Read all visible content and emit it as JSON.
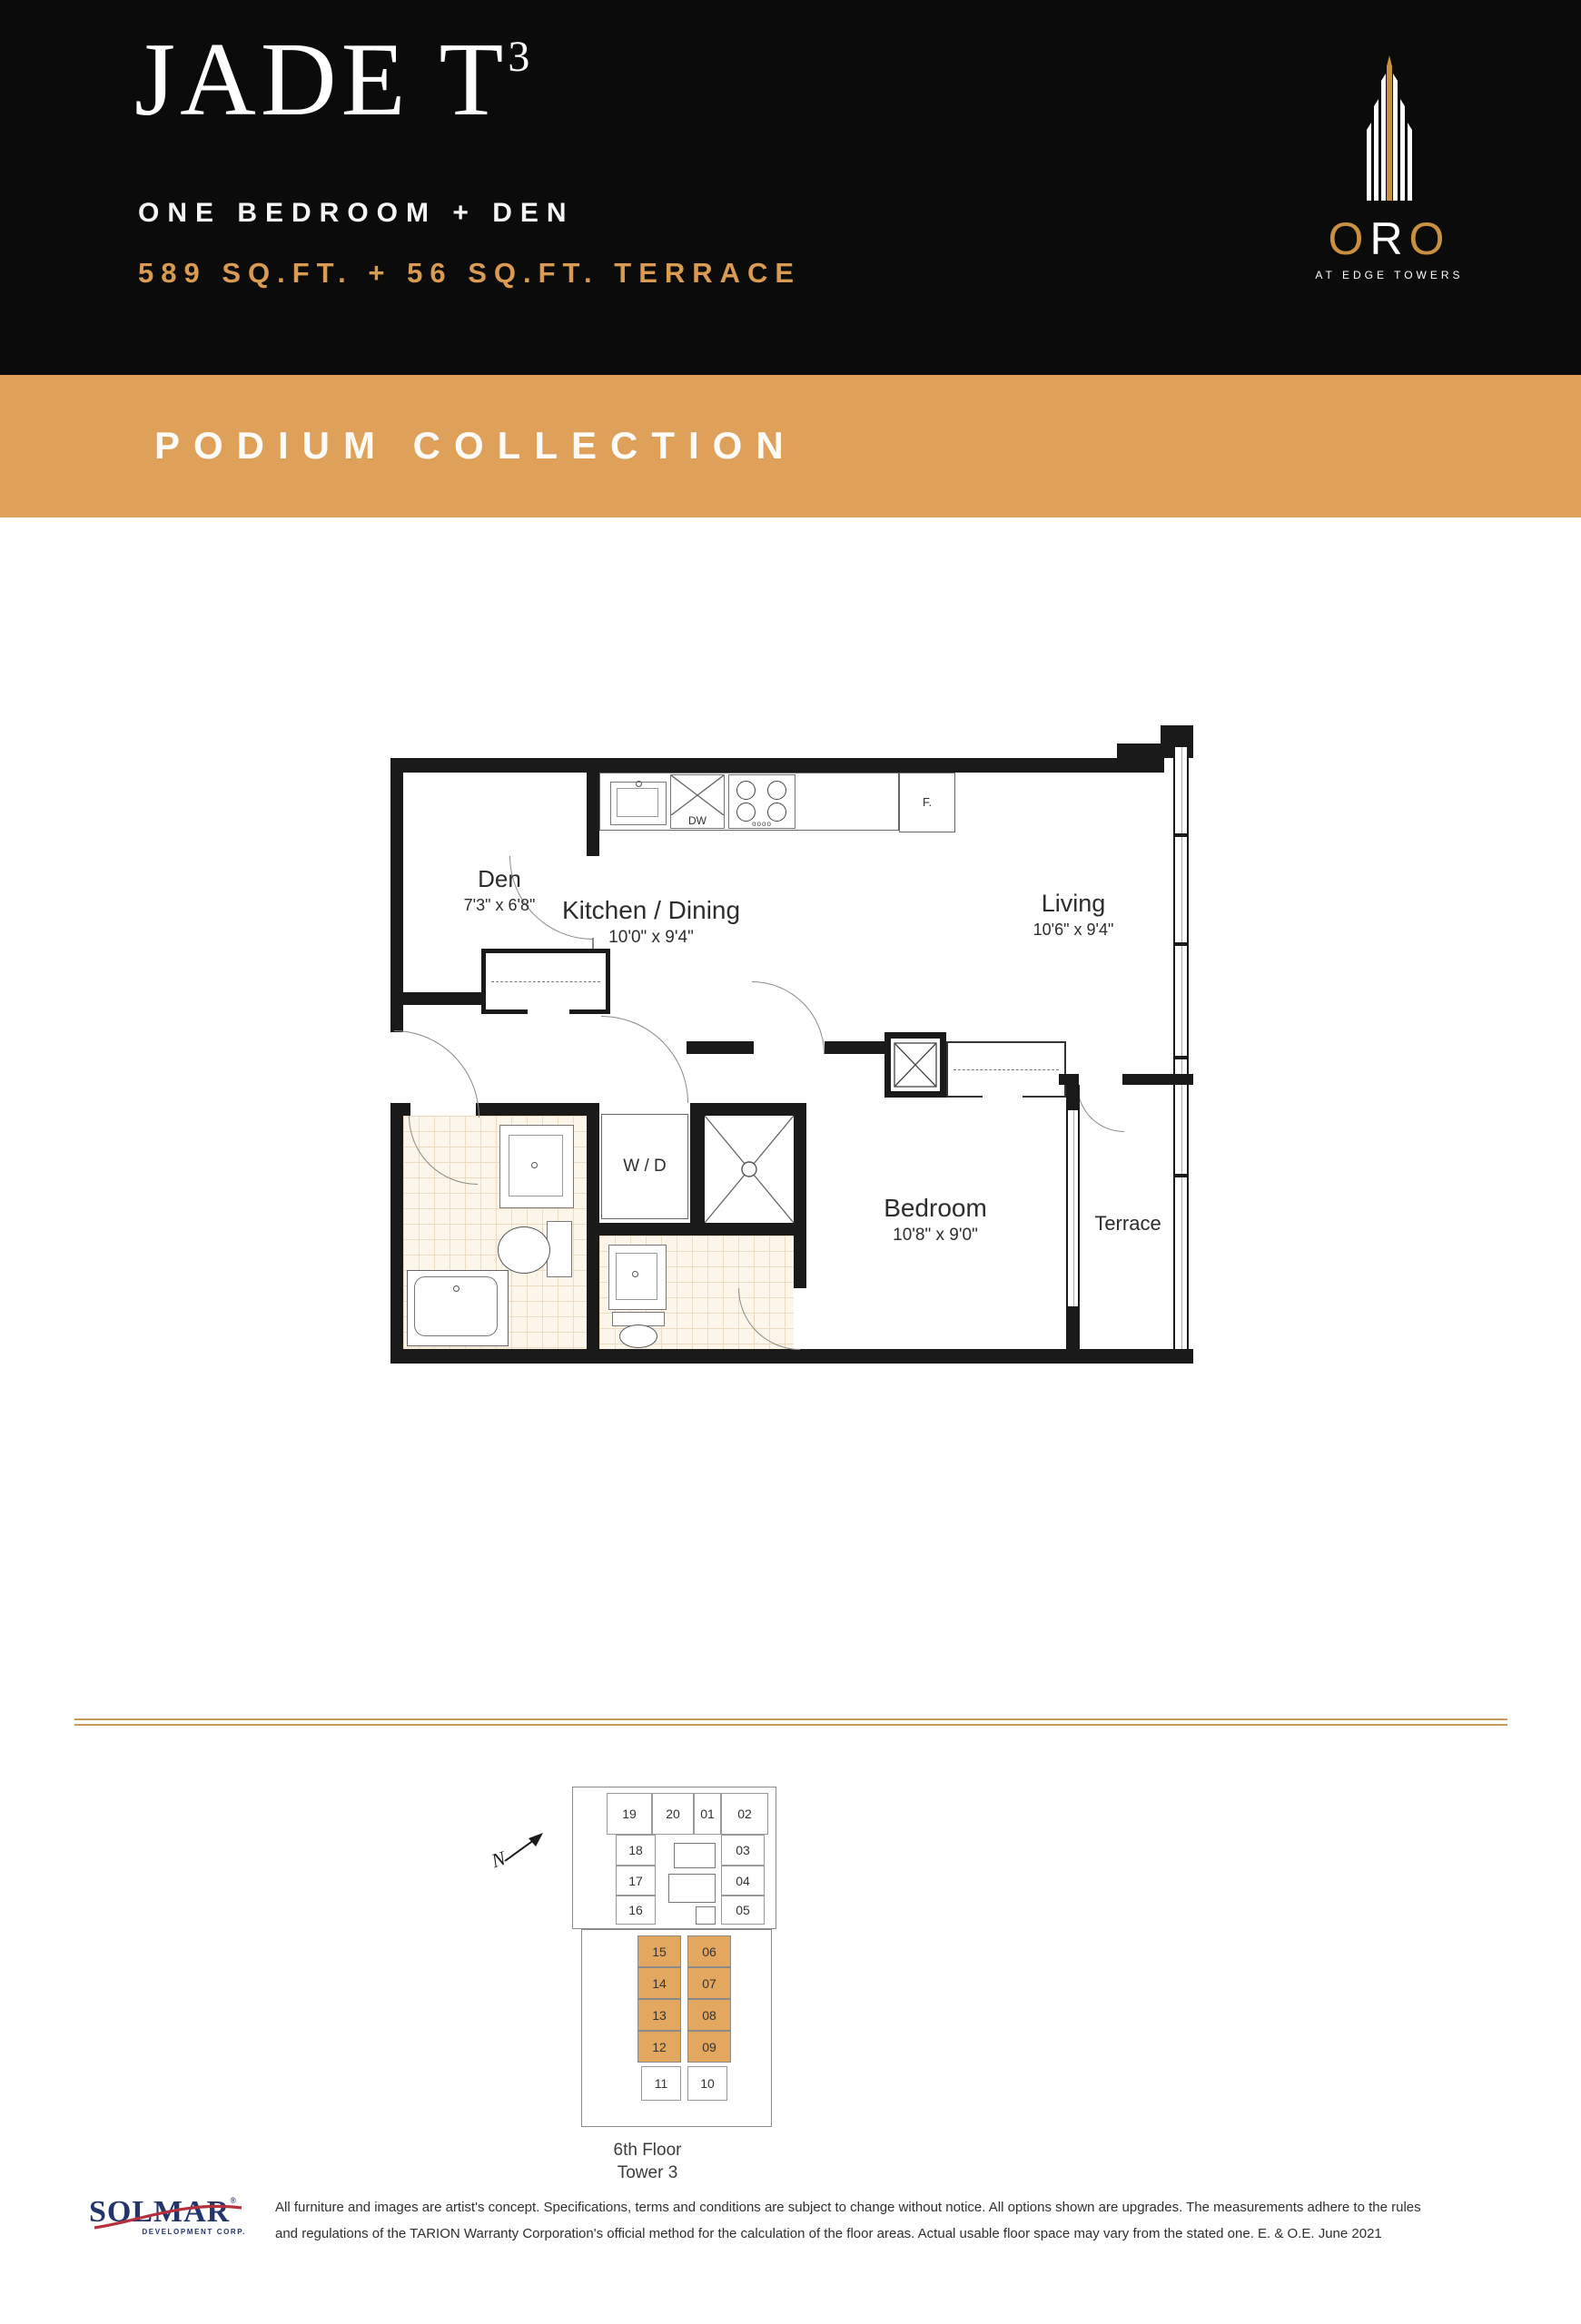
{
  "header": {
    "title": "JADE T",
    "title_sup": "3",
    "subtitle": "ONE BEDROOM + DEN",
    "area_line": "589 SQ.FT. + 56 SQ.FT. TERRACE",
    "logo": {
      "name_o1": "O",
      "name_r": "R",
      "name_o2": "O",
      "tagline": "AT EDGE TOWERS"
    }
  },
  "banner": {
    "label": "PODIUM COLLECTION"
  },
  "floorplan": {
    "rooms": [
      {
        "name": "Den",
        "dims": "7'3\" x 6'8\""
      },
      {
        "name": "Kitchen / Dining",
        "dims": "10'0\" x 9'4\""
      },
      {
        "name": "Living",
        "dims": "10'6\" x 9'4\""
      },
      {
        "name": "Bedroom",
        "dims": "10'8\" x 9'0\""
      },
      {
        "name": "Terrace",
        "dims": ""
      }
    ],
    "labels": {
      "washer_dryer": "W / D",
      "dishwasher": "DW",
      "fridge": "F."
    }
  },
  "keyplan": {
    "north_label": "N",
    "caption_line1": "6th Floor",
    "caption_line2": "Tower 3",
    "units": [
      {
        "label": "19",
        "slot": "u19",
        "highlighted": false
      },
      {
        "label": "20",
        "slot": "u20",
        "highlighted": false
      },
      {
        "label": "01",
        "slot": "u01",
        "highlighted": false
      },
      {
        "label": "02",
        "slot": "u02",
        "highlighted": false
      },
      {
        "label": "18",
        "slot": "u18",
        "highlighted": false
      },
      {
        "label": "17",
        "slot": "u17",
        "highlighted": false
      },
      {
        "label": "16",
        "slot": "u16",
        "highlighted": false
      },
      {
        "label": "03",
        "slot": "u03",
        "highlighted": false
      },
      {
        "label": "04",
        "slot": "u04",
        "highlighted": false
      },
      {
        "label": "05",
        "slot": "u05",
        "highlighted": false
      },
      {
        "label": "15",
        "slot": "u15",
        "highlighted": true
      },
      {
        "label": "14",
        "slot": "u14",
        "highlighted": true
      },
      {
        "label": "13",
        "slot": "u13",
        "highlighted": true
      },
      {
        "label": "12",
        "slot": "u12",
        "highlighted": true
      },
      {
        "label": "06",
        "slot": "u06",
        "highlighted": true
      },
      {
        "label": "07",
        "slot": "u07",
        "highlighted": true
      },
      {
        "label": "08",
        "slot": "u08",
        "highlighted": true
      },
      {
        "label": "09",
        "slot": "u09",
        "highlighted": true
      },
      {
        "label": "11",
        "slot": "u11",
        "highlighted": false
      },
      {
        "label": "10",
        "slot": "u10",
        "highlighted": false
      }
    ]
  },
  "footer": {
    "logo_text": "SOLMAR",
    "logo_reg": "®",
    "logo_sub": "DEVELOPMENT CORP.",
    "disclaimer_line1": "All furniture and images are artist's concept. Specifications, terms and conditions are subject to change without notice. All options shown are upgrades. The measurements adhere to the rules",
    "disclaimer_line2": "and regulations of the TARION Warranty Corporation's official method for the calculation of the floor areas. Actual usable floor space may vary from the stated one. E. & O.E. June 2021"
  },
  "colors": {
    "header_bg": "#0b0b0b",
    "banner_bg": "#DFA159",
    "gold_text": "#D99B51",
    "unit_highlight": "#E3A75F",
    "solmar_blue": "#24356B",
    "solmar_red": "#B5303A"
  }
}
